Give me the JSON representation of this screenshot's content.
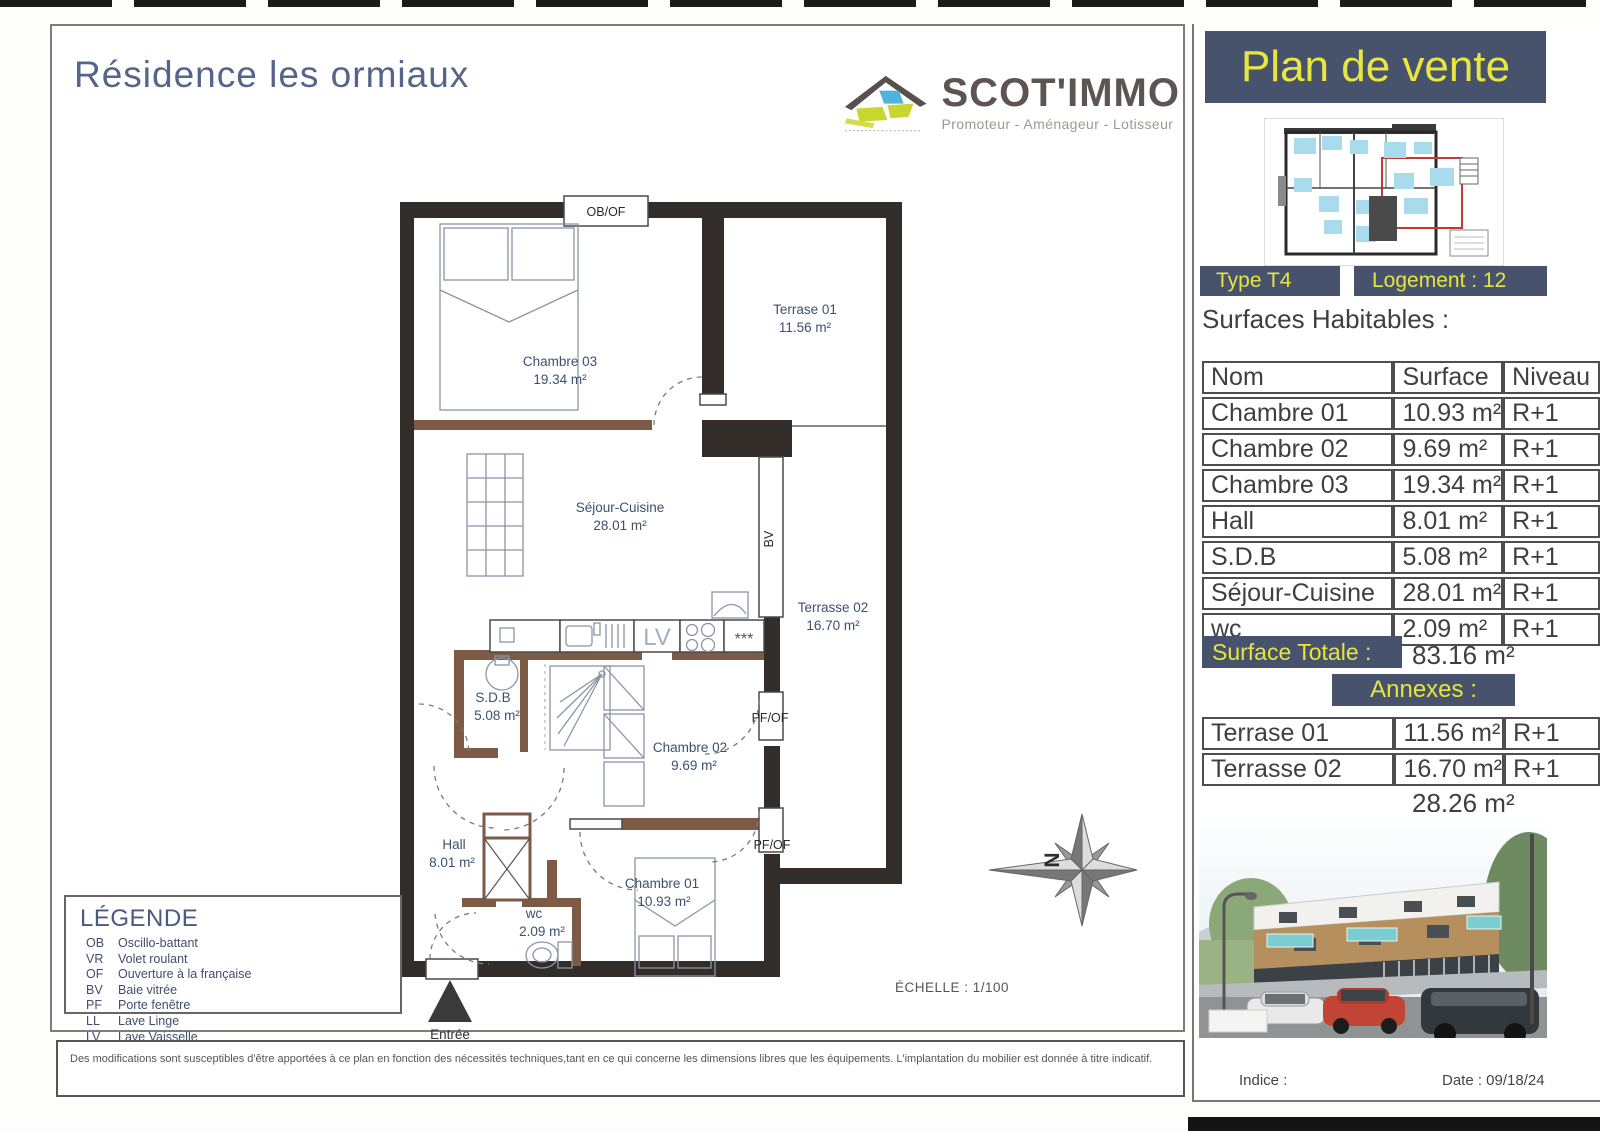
{
  "header": {
    "title": "Résidence les ormiaux"
  },
  "logo": {
    "name": "SCOT'IMMO",
    "tagline": "Promoteur - Aménageur - Lotisseur"
  },
  "plan": {
    "rooms": [
      {
        "name": "Chambre 03",
        "area": "19.34 m²"
      },
      {
        "name": "Terrase 01",
        "area": "11.56 m²"
      },
      {
        "name": "Séjour-Cuisine",
        "area": "28.01 m²"
      },
      {
        "name": "Terrasse 02",
        "area": "16.70 m²"
      },
      {
        "name": "S.D.B",
        "area": "5.08 m²"
      },
      {
        "name": "Chambre 02",
        "area": "9.69 m²"
      },
      {
        "name": "Hall",
        "area": "8.01 m²"
      },
      {
        "name": "wc",
        "area": "2.09 m²"
      },
      {
        "name": "Chambre 01",
        "area": "10.93 m²"
      }
    ],
    "labels": {
      "obof": "OB/OF",
      "bv": "BV",
      "pfof1": "PF/OF",
      "pfof2": "PF/OF",
      "lv": "LV",
      "stars": "***"
    },
    "scale": "ÉCHELLE : 1/100",
    "entrance": "Entrée",
    "north": "N"
  },
  "legend": {
    "title": "LÉGENDE",
    "items": [
      {
        "abbr": "OB",
        "label": "Oscillo-battant"
      },
      {
        "abbr": "VR",
        "label": "Volet roulant"
      },
      {
        "abbr": "OF",
        "label": "Ouverture à la française"
      },
      {
        "abbr": "BV",
        "label": "Baie vitrée"
      },
      {
        "abbr": "PF",
        "label": "Porte fenêtre"
      },
      {
        "abbr": "LL",
        "label": "Lave Linge"
      },
      {
        "abbr": "LV",
        "label": "Lave Vaisselle"
      }
    ]
  },
  "disclaimer": "Des modifications sont susceptibles d'être apportées à ce plan en fonction des nécessités techniques,tant en ce qui concerne les dimensions libres que les équipements. L'implantation du mobilier est donnée à titre indicatif.",
  "sidebar": {
    "banner": "Plan de vente",
    "type_label": "Type T4",
    "logement_label": "Logement : 12",
    "surfaces_title": "Surfaces Habitables :",
    "table": {
      "headers": [
        "Nom",
        "Surface",
        "Niveau"
      ],
      "rows": [
        [
          "Chambre 01",
          "10.93 m²",
          "R+1"
        ],
        [
          "Chambre 02",
          "9.69 m²",
          "R+1"
        ],
        [
          "Chambre 03",
          "19.34 m²",
          "R+1"
        ],
        [
          "Hall",
          "8.01 m²",
          "R+1"
        ],
        [
          "S.D.B",
          "5.08 m²",
          "R+1"
        ],
        [
          "Séjour-Cuisine",
          "28.01 m²",
          "R+1"
        ],
        [
          "wc",
          "2.09 m²",
          "R+1"
        ]
      ]
    },
    "surface_totale_label": "Surface Totale :",
    "surface_totale_value": "83.16 m²",
    "annexes_title": "Annexes :",
    "annexes_rows": [
      [
        "Terrase 01",
        "11.56 m²",
        "R+1"
      ],
      [
        "Terrasse 02",
        "16.70 m²",
        "R+1"
      ]
    ],
    "annexes_total": "28.26 m²",
    "footer": {
      "indice": "Indice :",
      "date": "Date : 09/18/24"
    }
  },
  "colors": {
    "accent_navy": "#47526d",
    "accent_yellow": "#e6e53e",
    "wall_dark": "#332d29",
    "wall_brown": "#7d5a45",
    "label_navy": "#3b5172",
    "title_slate": "#55648a",
    "logo_blue": "#4fb3dc",
    "logo_green": "#c8d62f"
  }
}
